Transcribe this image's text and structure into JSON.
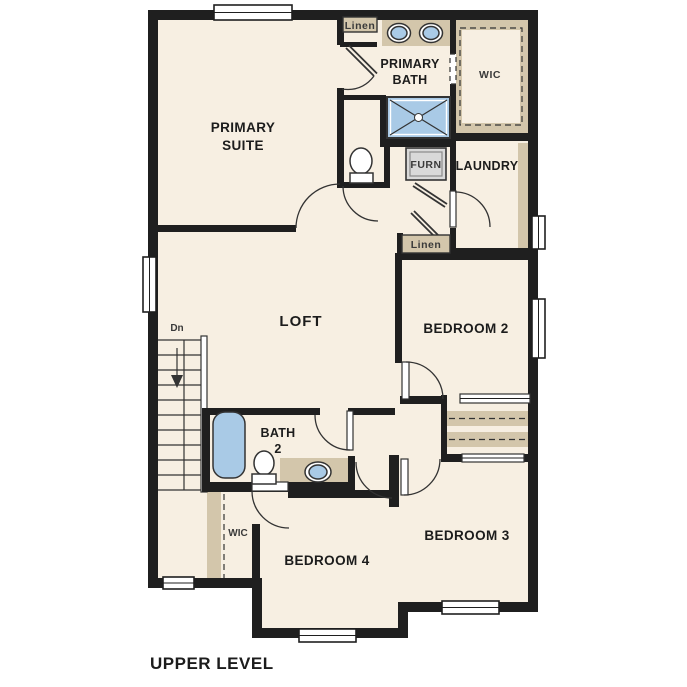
{
  "title": "UPPER LEVEL",
  "rooms": {
    "primary_suite": {
      "line1": "PRIMARY",
      "line2": "SUITE"
    },
    "primary_bath": {
      "line1": "PRIMARY",
      "line2": "BATH"
    },
    "loft": {
      "label": "LOFT"
    },
    "bedroom2": {
      "label": "BEDROOM 2"
    },
    "bedroom3": {
      "label": "BEDROOM 3"
    },
    "bedroom4": {
      "label": "BEDROOM 4"
    },
    "bath2": {
      "line1": "BATH",
      "line2": "2"
    },
    "laundry": {
      "label": "LAUNDRY"
    },
    "wic_upper": {
      "label": "WIC"
    },
    "wic_lower": {
      "label": "WIC"
    },
    "linen_upper": {
      "label": "Linen"
    },
    "linen_hall": {
      "label": "Linen"
    },
    "furnace": {
      "label": "FURN"
    },
    "stairs": {
      "label": "Dn"
    }
  },
  "colors": {
    "wall_color": "#1f1f1f",
    "room_fill": "#f7efe2",
    "tan_fill": "#d3c6ab",
    "blue_fill": "#a9cae6",
    "gray_fill": "#d9d9d9",
    "window_fill": "#ffffff",
    "text_color": "#1c1c1c",
    "small_text_color": "#3a3a3a",
    "line_color": "#333333"
  }
}
